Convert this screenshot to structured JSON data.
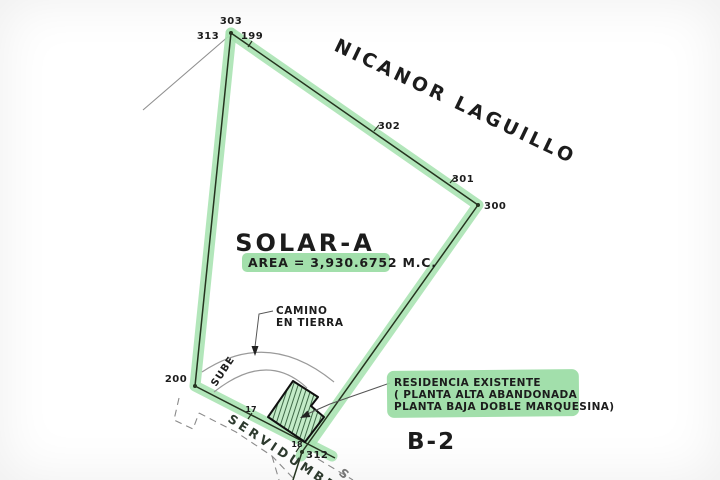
{
  "street": {
    "name": "NICANOR LAGUILLO"
  },
  "parcel": {
    "name": "SOLAR-A",
    "area": "AREA = 3,930.6752 M.C."
  },
  "points": {
    "p303": "303",
    "p313": "313",
    "p199": "199",
    "p302": "302",
    "p301": "301",
    "p300": "300",
    "p200": "200",
    "p312": "312"
  },
  "ticks": {
    "t17": "17",
    "t18": "18"
  },
  "road": {
    "line1": "CAMINO",
    "line2": "EN TIERRA",
    "sube": "SUBE"
  },
  "easement": {
    "label": "SERVIDUMBRE"
  },
  "residence": {
    "line1": "RESIDENCIA EXISTENTE",
    "line2": "( PLANTA ALTA ABANDONADA",
    "line3": "PLANTA BAJA DOBLE MARQUESINA)"
  },
  "block": {
    "label": "B-2"
  },
  "partial": {
    "label": "S"
  },
  "colors": {
    "highlight": "#98dba2",
    "band": "#a7e3b0",
    "boundary": "#25341f",
    "hatch": "#2f5a38",
    "hatch_fill": "#c3ebc8",
    "thin": "#8f8f8f",
    "ink": "#1c1c1c"
  }
}
